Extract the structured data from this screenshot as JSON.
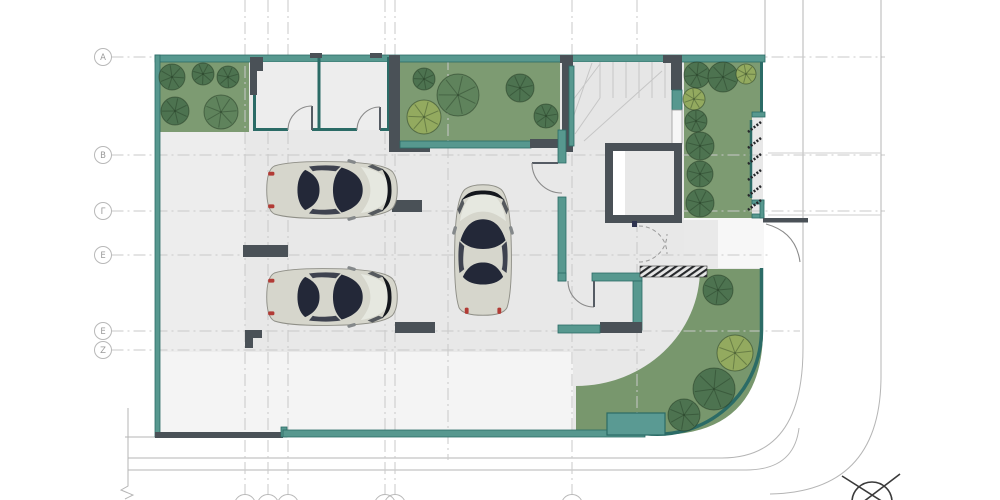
{
  "drawing": {
    "type": "architectural-floor-plan",
    "visible_text_labels": [
      "A",
      "B",
      "Γ",
      "E",
      "E",
      "Z"
    ]
  },
  "grid": {
    "rows": [
      {
        "label": "A",
        "y": 57,
        "end": 885
      },
      {
        "label": "B",
        "y": 155,
        "end": 885
      },
      {
        "label": "Γ",
        "y": 211,
        "end": 885
      },
      {
        "label": "E",
        "y": 255,
        "end": 768
      },
      {
        "label": "E",
        "y": 331,
        "end": 800
      },
      {
        "label": "Z",
        "y": 350,
        "end": 645
      }
    ],
    "bubble_x": 103,
    "bubble_radius": 8.5,
    "cols": [
      {
        "x": 245,
        "y1": 0,
        "y2": 494,
        "bubble": true
      },
      {
        "x": 268,
        "y1": 0,
        "y2": 494,
        "bubble": true
      },
      {
        "x": 288,
        "y1": 0,
        "y2": 494,
        "bubble": true
      },
      {
        "x": 385,
        "y1": 0,
        "y2": 494,
        "bubble": true
      },
      {
        "x": 395,
        "y1": 0,
        "y2": 494,
        "bubble": true
      },
      {
        "x": 448,
        "y1": 58,
        "y2": 460,
        "bubble": false
      },
      {
        "x": 572,
        "y1": 0,
        "y2": 494,
        "bubble": true
      },
      {
        "x": 637,
        "y1": 0,
        "y2": 437,
        "bubble": false
      }
    ],
    "bottom_bubble_y": 505,
    "bottom_bubble_radius": 10.5
  },
  "trees": [
    {
      "cx": 172,
      "cy": 77,
      "r": 13,
      "shade": "dark"
    },
    {
      "cx": 203,
      "cy": 74,
      "r": 11,
      "shade": "dark"
    },
    {
      "cx": 228,
      "cy": 77,
      "r": 11,
      "shade": "dark"
    },
    {
      "cx": 175,
      "cy": 111,
      "r": 14,
      "shade": "dark"
    },
    {
      "cx": 221,
      "cy": 112,
      "r": 17,
      "shade": "mid"
    },
    {
      "cx": 424,
      "cy": 79,
      "r": 11,
      "shade": "dark"
    },
    {
      "cx": 458,
      "cy": 95,
      "r": 21,
      "shade": "mid"
    },
    {
      "cx": 424,
      "cy": 117,
      "r": 17,
      "shade": "light"
    },
    {
      "cx": 520,
      "cy": 88,
      "r": 14,
      "shade": "dark"
    },
    {
      "cx": 546,
      "cy": 116,
      "r": 12,
      "shade": "dark"
    },
    {
      "cx": 697,
      "cy": 75,
      "r": 13,
      "shade": "dark"
    },
    {
      "cx": 723,
      "cy": 77,
      "r": 15,
      "shade": "dark"
    },
    {
      "cx": 746,
      "cy": 74,
      "r": 10,
      "shade": "light"
    },
    {
      "cx": 694,
      "cy": 99,
      "r": 11,
      "shade": "light"
    },
    {
      "cx": 696,
      "cy": 121,
      "r": 11,
      "shade": "dark"
    },
    {
      "cx": 700,
      "cy": 146,
      "r": 14,
      "shade": "dark"
    },
    {
      "cx": 700,
      "cy": 174,
      "r": 13,
      "shade": "dark"
    },
    {
      "cx": 700,
      "cy": 203,
      "r": 14,
      "shade": "dark"
    },
    {
      "cx": 718,
      "cy": 290,
      "r": 15,
      "shade": "dark"
    },
    {
      "cx": 735,
      "cy": 353,
      "r": 18,
      "shade": "light"
    },
    {
      "cx": 714,
      "cy": 389,
      "r": 21,
      "shade": "dark"
    },
    {
      "cx": 684,
      "cy": 415,
      "r": 16,
      "shade": "dark"
    }
  ],
  "cars": [
    {
      "cx": 332,
      "cy": 190,
      "deg": 0
    },
    {
      "cx": 332,
      "cy": 297,
      "deg": 0
    },
    {
      "cx": 483,
      "cy": 250,
      "deg": -90
    }
  ],
  "colors": {
    "wall_teal": "#57988f",
    "wall_teal_edge": "#2b6b66",
    "wall_dark": "#4a5157",
    "green_area": "#7d9b72",
    "tree_dark": "#4d7350",
    "tree_mid": "#5f835c",
    "tree_light": "#93aa5f",
    "floor_gray": "#e8e8e8",
    "yard_light": "#f4f4f4",
    "car_body": "#d6d6cc",
    "glass_dark": "#232838",
    "taillight_red": "#b23b35",
    "grid_gray": "#c9c9c9"
  },
  "icons": {
    "tree": "tree-icon",
    "car": "car-top-view",
    "north": "survey-marker-icon"
  }
}
